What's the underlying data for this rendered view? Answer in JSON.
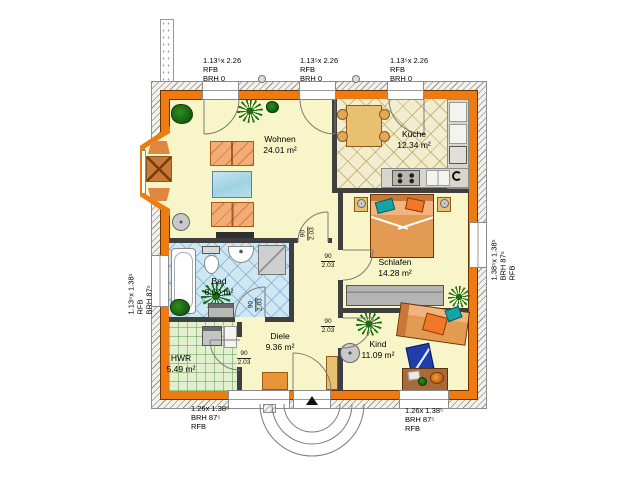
{
  "plan": {
    "rooms": [
      {
        "name": "Wohnen",
        "area": "24.01 m²"
      },
      {
        "name": "Küche",
        "area": "12.34 m²"
      },
      {
        "name": "Schlafen",
        "area": "14.28 m²"
      },
      {
        "name": "Kind",
        "area": "11.09 m²"
      },
      {
        "name": "Bad",
        "area": "8.60 m²"
      },
      {
        "name": "Diele",
        "area": "9.36 m²"
      },
      {
        "name": "HWR",
        "area": "5.49 m²"
      }
    ],
    "windows": {
      "top1": {
        "line1": "1.13⁵x 2.26",
        "line2": "RFB",
        "line3": "BRH 0"
      },
      "top2": {
        "line1": "1.13⁵x 2.26",
        "line2": "RFB",
        "line3": "BRH 0"
      },
      "top3": {
        "line1": "1.13⁵x 2.26",
        "line2": "RFB",
        "line3": "BRH 0"
      },
      "left": {
        "line1": "1.13⁵x 1.38⁵",
        "line2": "RFB",
        "line3": "BRH 87⁵"
      },
      "right": {
        "line1": "1.38⁵x 1.38⁵",
        "line2": "BRH 87⁵",
        "line3": "RFB"
      },
      "bottom1": {
        "line1": "1.26x 1.38⁵",
        "line2": "BRH 87⁵",
        "line3": "RFB"
      },
      "bottom2": {
        "line1": "1.26x 1.38⁵",
        "line2": "BRH 87⁵",
        "line3": "RFB"
      }
    },
    "doors": [
      {
        "width": "90",
        "height": "2.03"
      },
      {
        "width": "90",
        "height": "2.03"
      },
      {
        "width": "90",
        "height": "2.03"
      },
      {
        "width": "90",
        "height": "2.03"
      },
      {
        "width": "90",
        "height": "2.03"
      }
    ],
    "colors": {
      "exterior_wall": "#EE7B12",
      "room_floor": "#F8F6C8",
      "kitchen_tile": "#F2EDCF",
      "bath_tile": "#CFE7F2",
      "utility_tile": "#E2F0D0",
      "furniture_orange": "#F2AC74",
      "accent_teal": "#17A3A3",
      "table_blue": "#AFD9E6"
    }
  }
}
